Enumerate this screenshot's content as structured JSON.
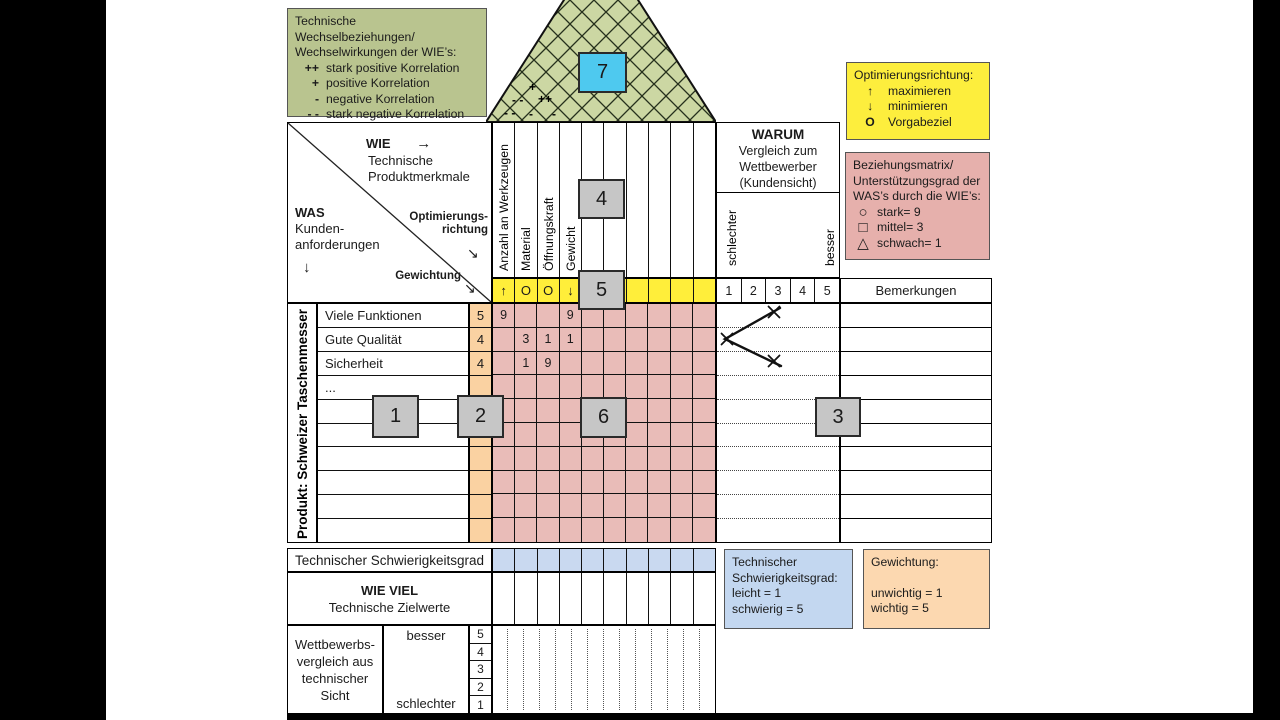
{
  "legend_correlation": {
    "title_line1": "Technische Wechselbeziehungen/",
    "title_line2": "Wechselwirkungen der WIE’s:",
    "items": [
      {
        "symbol": "++",
        "label": "stark positive Korrelation"
      },
      {
        "symbol": "+",
        "label": "positive Korrelation"
      },
      {
        "symbol": "-",
        "label": "negative Korrelation"
      },
      {
        "symbol": "- -",
        "label": "stark negative Korrelation"
      }
    ]
  },
  "legend_optimization": {
    "title": "Optimierungsrichtung:",
    "items": [
      {
        "symbol": "↑",
        "label": "maximieren"
      },
      {
        "symbol": "↓",
        "label": "minimieren"
      },
      {
        "symbol": "O",
        "label": "Vorgabeziel"
      }
    ]
  },
  "legend_relationship": {
    "title_lines": [
      "Beziehungsmatrix/",
      "Unterstützungsgrad der",
      "WAS’s durch die WIE’s:"
    ],
    "items": [
      {
        "symbol": "○",
        "label": "stark= 9"
      },
      {
        "symbol": "□",
        "label": "mittel= 3"
      },
      {
        "symbol": "△",
        "label": "schwach= 1"
      }
    ]
  },
  "legend_difficulty": {
    "lines": [
      "Technischer",
      "Schwierigkeitsgrad:",
      "leicht = 1",
      "schwierig = 5"
    ]
  },
  "legend_weighting": {
    "title": "Gewichtung:",
    "lines": [
      "unwichtig = 1",
      "wichtig = 5"
    ]
  },
  "roof": {
    "marker": "7",
    "symbols": [
      "+",
      "- -",
      "++",
      "- -",
      "-",
      "-"
    ]
  },
  "header": {
    "wie_label": "WIE",
    "wie_arrow": "→",
    "wie_sub1": "Technische",
    "wie_sub2": "Produktmerkmale",
    "was_label": "WAS",
    "was_sub1": "Kunden-",
    "was_sub2": "anforderungen",
    "was_arrow": "↓",
    "opt_label1": "Optimierungs-",
    "opt_label2": "richtung",
    "opt_arrow": "↘",
    "weight_label": "Gewichtung",
    "weight_arrow": "↘"
  },
  "warum": {
    "title": "WARUM",
    "sub1": "Vergleich zum",
    "sub2": "Wettbewerber",
    "sub3": "(Kundensicht)",
    "worse": "schlechter",
    "better": "besser",
    "scale": [
      "1",
      "2",
      "3",
      "4",
      "5"
    ],
    "remarks_header": "Bemerkungen"
  },
  "columns": [
    "Anzahl an Werkzeugen",
    "Material",
    "Öffnungskraft",
    "Gewicht"
  ],
  "optimization_row": [
    "↑",
    "O",
    "O",
    "↓",
    "",
    "",
    "",
    "",
    "",
    ""
  ],
  "product_label": "Produkt: Schweizer Taschenmesser",
  "matrix": {
    "row_labels": [
      "Viele Funktionen",
      "Gute Qualität",
      "Sicherheit",
      "...",
      "",
      "",
      "",
      "",
      "",
      ""
    ],
    "weights": [
      "5",
      "4",
      "4",
      "",
      "",
      "",
      "",
      "",
      "",
      ""
    ],
    "cells": [
      [
        "9",
        "",
        "",
        "9",
        "",
        "",
        "",
        "",
        "",
        ""
      ],
      [
        "",
        "3",
        "1",
        "1",
        "",
        "",
        "",
        "",
        "",
        ""
      ],
      [
        "",
        "1",
        "9",
        "",
        "",
        "",
        "",
        "",
        "",
        ""
      ],
      [
        "",
        "",
        "",
        "",
        "",
        "",
        "",
        "",
        "",
        ""
      ],
      [
        "",
        "",
        "",
        "",
        "",
        "",
        "",
        "",
        "",
        ""
      ],
      [
        "",
        "",
        "",
        "",
        "",
        "",
        "",
        "",
        "",
        ""
      ],
      [
        "",
        "",
        "",
        "",
        "",
        "",
        "",
        "",
        "",
        ""
      ],
      [
        "",
        "",
        "",
        "",
        "",
        "",
        "",
        "",
        "",
        ""
      ],
      [
        "",
        "",
        "",
        "",
        "",
        "",
        "",
        "",
        "",
        ""
      ],
      [
        "",
        "",
        "",
        "",
        "",
        "",
        "",
        "",
        "",
        ""
      ]
    ]
  },
  "bottom": {
    "difficulty_row_label": "Technischer Schwierigkeitsgrad",
    "wieviel_title": "WIE VIEL",
    "wieviel_sub": "Technische Zielwerte",
    "compare_label_lines": [
      "Wettbewerbs-",
      "vergleich aus",
      "technischer",
      "Sicht"
    ],
    "better": "besser",
    "worse": "schlechter",
    "scale": [
      "5",
      "4",
      "3",
      "2",
      "1"
    ]
  },
  "markers": [
    "1",
    "2",
    "3",
    "4",
    "5",
    "6",
    "7"
  ],
  "colors": {
    "legend_green": "#b9c48f",
    "roof_green": "#ccd7a3",
    "cyan": "#4ec9ef",
    "yellow": "#ffee3a",
    "matrix_pink": "#e9bcb8",
    "legend_pink": "#e6b0ac",
    "weight_orange": "#fad2a2",
    "legend_orange": "#fcd8b0",
    "difficulty_blue": "#c9d9f0",
    "legend_blue": "#c3d7f0",
    "marker_gray": "#c6c6c6"
  }
}
